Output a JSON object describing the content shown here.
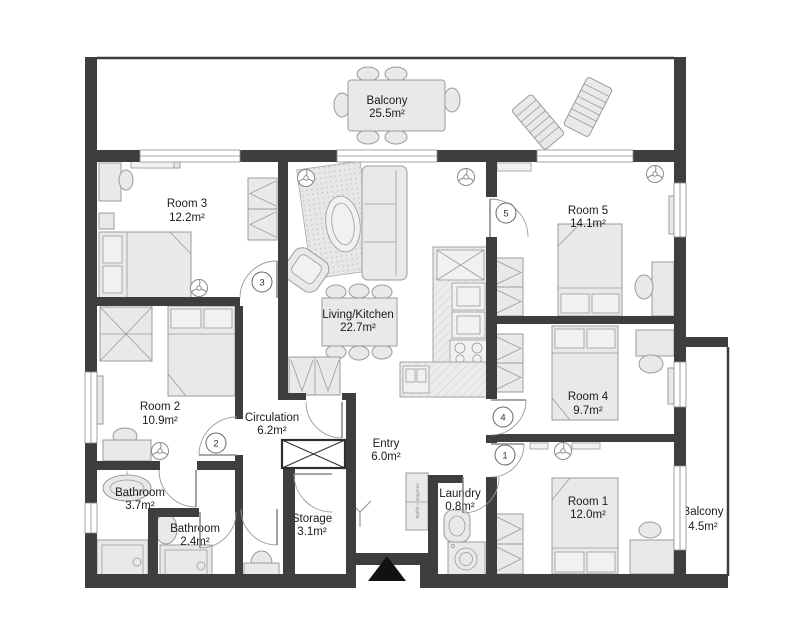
{
  "plan_title": "Apartment floor plan",
  "rooms": [
    {
      "name": "Balcony",
      "area": "25.5m²"
    },
    {
      "name": "Room 3",
      "area": "12.2m²"
    },
    {
      "name": "Living/Kitchen",
      "area": "22.7m²"
    },
    {
      "name": "Room 5",
      "area": "14.1m²"
    },
    {
      "name": "Room 2",
      "area": "10.9m²"
    },
    {
      "name": "Circulation",
      "area": "6.2m²"
    },
    {
      "name": "Entry",
      "area": "6.0m²"
    },
    {
      "name": "Room 4",
      "area": "9.7m²"
    },
    {
      "name": "Room 1",
      "area": "12.0m²"
    },
    {
      "name": "Bathroom",
      "area": "3.7m²"
    },
    {
      "name": "Bathroom",
      "area": "2.4m²"
    },
    {
      "name": "Storage",
      "area": "3.1m²"
    },
    {
      "name": "Laundry",
      "area": "0.8m²"
    },
    {
      "name": "Balcony",
      "area": "4.5m²"
    }
  ],
  "doors": [
    {
      "number": "1"
    },
    {
      "number": "2"
    },
    {
      "number": "3"
    },
    {
      "number": "4"
    },
    {
      "number": "5"
    }
  ],
  "annotations": {
    "buffet_shelf": "Buffet + étagères"
  },
  "colors": {
    "wall": "#3e3e3e",
    "furniture_fill": "#e9e9e9",
    "furniture_stroke": "#9b9b9b",
    "entrance_marker": "#111111"
  }
}
